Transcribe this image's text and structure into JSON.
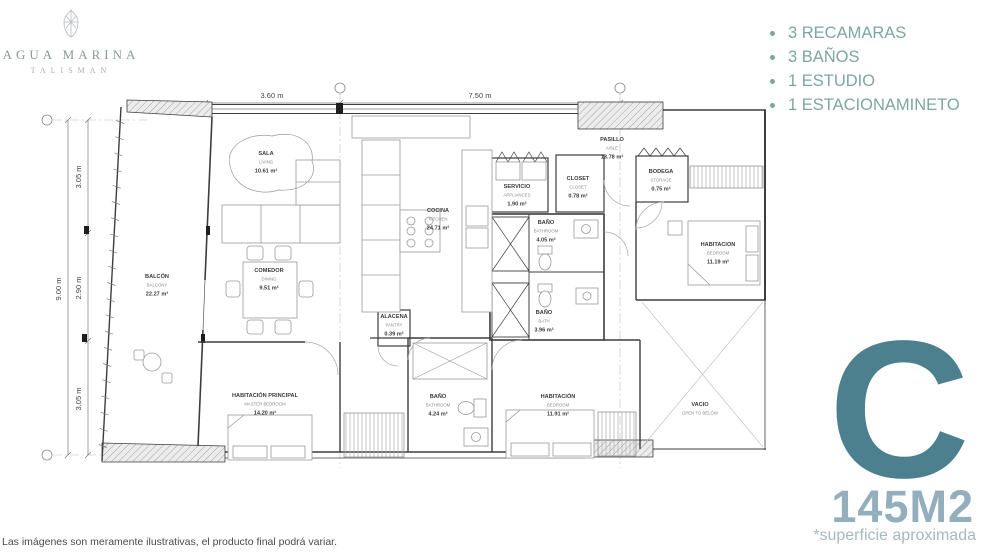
{
  "brand": {
    "line1": "AGUA MARINA",
    "line2": "TALISMAN"
  },
  "features": {
    "items": [
      "3 RECAMARAS",
      "3 BAÑOS",
      "1 ESTUDIO",
      "1 ESTACIONAMINETO"
    ]
  },
  "unit": {
    "letter": "C",
    "area": "145M2",
    "note": "*superficie aproximada"
  },
  "disclaimer": "Las imágenes son meramente ilustrativas, el producto final podrá variar.",
  "colors": {
    "accent_teal": "#4d808e",
    "accent_light_blue": "#93aebc",
    "feature_text": "#7ca7a0",
    "plan_dark": "#3d3d3d",
    "plan_light": "#9a9a9a"
  },
  "plan": {
    "dimensions": {
      "top": [
        "3.60 m",
        "7.50 m"
      ],
      "left_total": "9.00 m",
      "left_segments": [
        "3.05 m",
        "2.90 m",
        "3.05 m"
      ]
    },
    "rooms": [
      {
        "id": "sala",
        "name": "SALA",
        "name_en": "LIVING",
        "area": "10.61 m²"
      },
      {
        "id": "comedor",
        "name": "COMEDOR",
        "name_en": "DINING",
        "area": "9.51 m²"
      },
      {
        "id": "cocina",
        "name": "COCINA",
        "name_en": "KITCHEN",
        "area": "24.71 m²"
      },
      {
        "id": "balcon",
        "name": "BALCÓN",
        "name_en": "BALCONY",
        "area": "22.27 m²"
      },
      {
        "id": "alacena",
        "name": "ALACENA",
        "name_en": "PANTRY",
        "area": "0.39 m²"
      },
      {
        "id": "servicio",
        "name": "SERVICIO",
        "name_en": "APPLIANCES",
        "area": "1.90 m²"
      },
      {
        "id": "closet",
        "name": "CLOSET",
        "name_en": "CLOSET",
        "area": "0.78 m²"
      },
      {
        "id": "bano1",
        "name": "BAÑO",
        "name_en": "BATHROOM",
        "area": "4.05 m²"
      },
      {
        "id": "bano2",
        "name": "BAÑO",
        "name_en": "BATH",
        "area": "3.96 m²"
      },
      {
        "id": "bano3",
        "name": "BAÑO",
        "name_en": "BATHROOM",
        "area": "4.24 m²"
      },
      {
        "id": "pasillo",
        "name": "PASILLO",
        "name_en": "AISLE",
        "area": "13.78 m²"
      },
      {
        "id": "bodega",
        "name": "BODEGA",
        "name_en": "STORAGE",
        "area": "0.75 m²"
      },
      {
        "id": "habitacion1",
        "name": "HABITACION",
        "name_en": "BEDROOM",
        "area": "11.19 m²"
      },
      {
        "id": "principal",
        "name": "HABITACIÓN PRINCIPAL",
        "name_en": "MASTER BEDROOM",
        "area": "14.20 m²"
      },
      {
        "id": "habitacion2",
        "name": "HABITACIÓN",
        "name_en": "BEDROOM",
        "area": "11.91 m²"
      },
      {
        "id": "vacio",
        "name": "VACIO",
        "name_en": "OPEN TO BELOW",
        "area": ""
      }
    ]
  }
}
